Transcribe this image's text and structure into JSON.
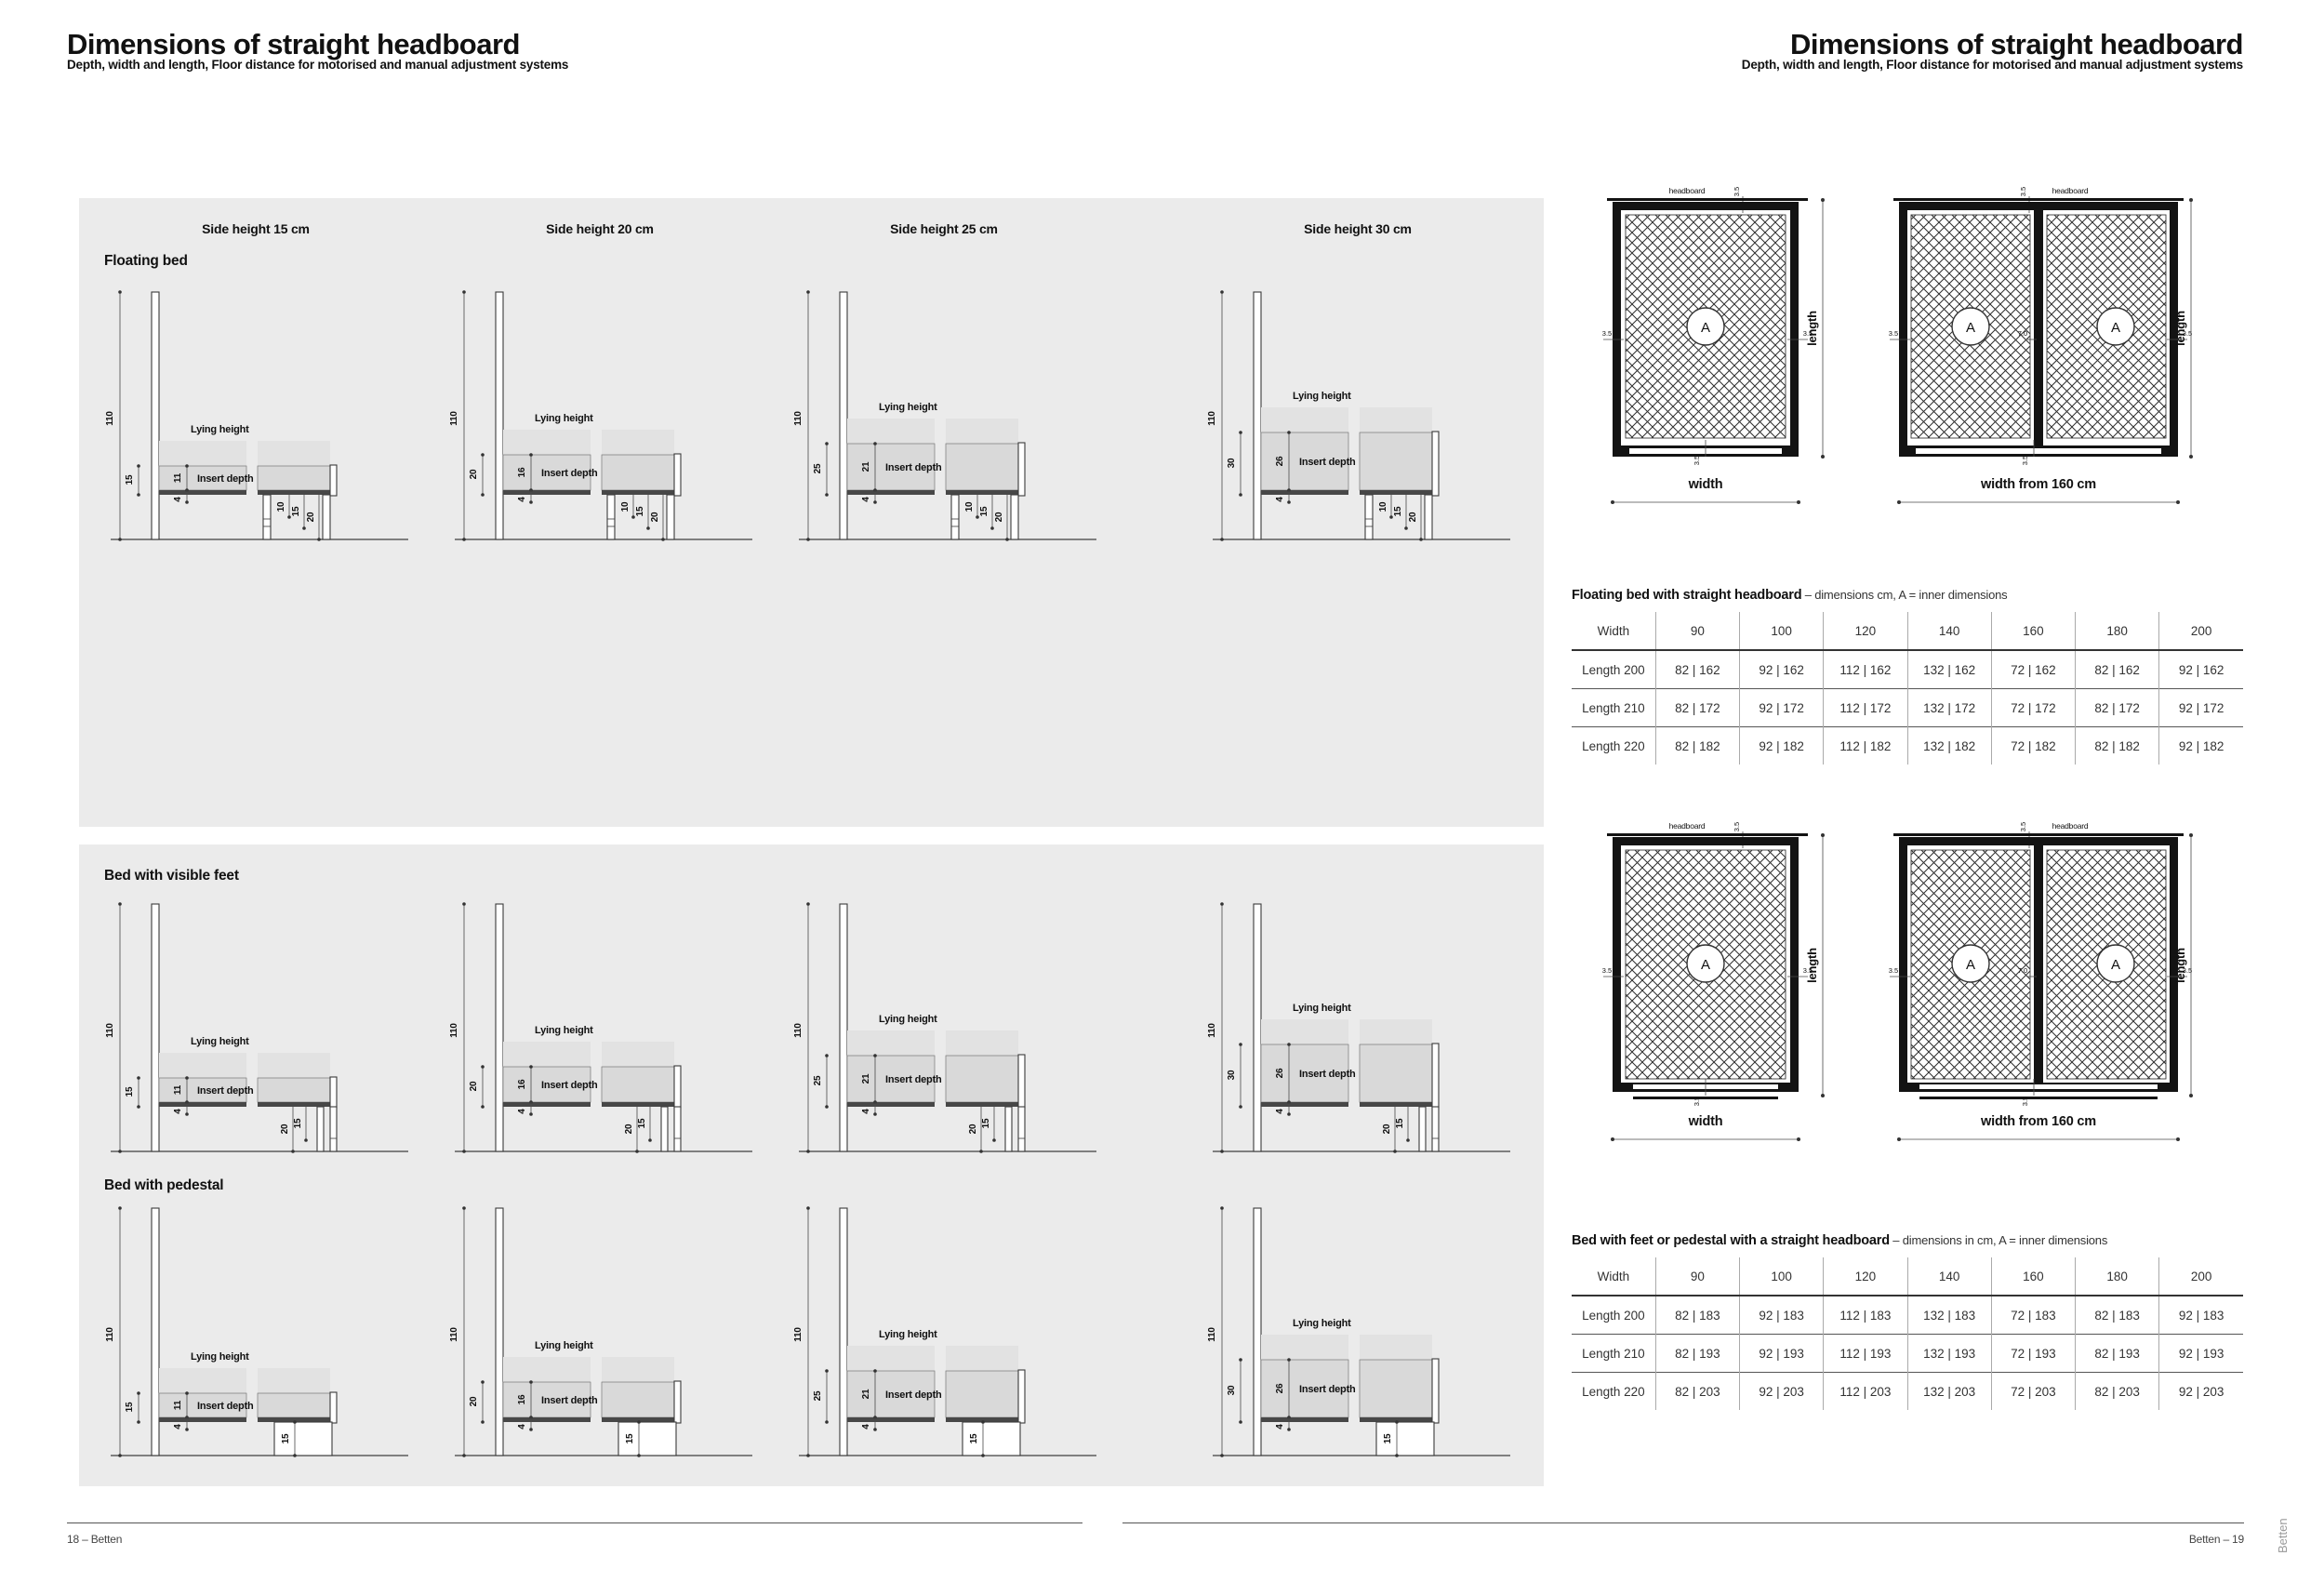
{
  "page_left": {
    "title": "Dimensions of straight headboard",
    "subtitle": "Depth, width and length, Floor distance for motorised and manual adjustment systems",
    "column_headers": [
      "Side height 15 cm",
      "Side height 20 cm",
      "Side height 25 cm",
      "Side height 30 cm"
    ],
    "labels": {
      "lying": "Lying height",
      "insert": "Insert depth"
    },
    "sections": [
      {
        "label": "Floating bed",
        "cols": [
          {
            "total": "110",
            "side": "15",
            "insert": "11",
            "base": "4",
            "floor1": "10",
            "floor2": "15",
            "floor3": "20"
          },
          {
            "total": "110",
            "side": "20",
            "insert": "16",
            "base": "4",
            "floor1": "10",
            "floor2": "15",
            "floor3": "20"
          },
          {
            "total": "110",
            "side": "25",
            "insert": "21",
            "base": "4",
            "floor1": "10",
            "floor2": "15",
            "floor3": "20"
          },
          {
            "total": "110",
            "side": "30",
            "insert": "26",
            "base": "4",
            "floor1": "10",
            "floor2": "15",
            "floor3": "20"
          }
        ]
      },
      {
        "label": "Bed with visible feet",
        "cols": [
          {
            "total": "110",
            "side": "15",
            "insert": "11",
            "base": "4",
            "floor1": "20",
            "floor2": "15"
          },
          {
            "total": "110",
            "side": "20",
            "insert": "16",
            "base": "4",
            "floor1": "20",
            "floor2": "15"
          },
          {
            "total": "110",
            "side": "25",
            "insert": "21",
            "base": "4",
            "floor1": "20",
            "floor2": "15"
          },
          {
            "total": "110",
            "side": "30",
            "insert": "26",
            "base": "4",
            "floor1": "20",
            "floor2": "15"
          }
        ]
      },
      {
        "label": "Bed with pedestal",
        "cols": [
          {
            "total": "110",
            "side": "15",
            "insert": "11",
            "base": "4",
            "floor1": "15"
          },
          {
            "total": "110",
            "side": "20",
            "insert": "16",
            "base": "4",
            "floor1": "15"
          },
          {
            "total": "110",
            "side": "25",
            "insert": "21",
            "base": "4",
            "floor1": "15"
          },
          {
            "total": "110",
            "side": "30",
            "insert": "26",
            "base": "4",
            "floor1": "15"
          }
        ]
      }
    ],
    "footer": "18 – Betten"
  },
  "page_right": {
    "title": "Dimensions of straight headboard",
    "subtitle": "Depth, width and length, Floor distance for motorised and manual adjustment systems",
    "topviews": {
      "headboard": "headboard",
      "length": "length",
      "width": "width",
      "width160": "width from 160 cm",
      "d35": "3.5",
      "d70": "7.0",
      "inner": "A"
    },
    "table1": {
      "caption_bold": "Floating bed with straight headboard",
      "caption_rest": " – dimensions cm, A = inner dimensions",
      "headers": [
        "Width",
        "90",
        "100",
        "120",
        "140",
        "160",
        "180",
        "200"
      ],
      "rows": [
        [
          "Length 200",
          "82 | 162",
          "92 | 162",
          "112 | 162",
          "132 | 162",
          "72 | 162",
          "82 | 162",
          "92 | 162"
        ],
        [
          "Length 210",
          "82 | 172",
          "92 | 172",
          "112 | 172",
          "132 | 172",
          "72 | 172",
          "82 | 172",
          "92 | 172"
        ],
        [
          "Length 220",
          "82 | 182",
          "92 | 182",
          "112 | 182",
          "132 | 182",
          "72 | 182",
          "82 | 182",
          "92 | 182"
        ]
      ]
    },
    "table2": {
      "caption_bold": "Bed with feet or pedestal with a straight headboard",
      "caption_rest": " – dimensions in cm, A = inner dimensions",
      "headers": [
        "Width",
        "90",
        "100",
        "120",
        "140",
        "160",
        "180",
        "200"
      ],
      "rows": [
        [
          "Length 200",
          "82 | 183",
          "92 | 183",
          "112 | 183",
          "132 | 183",
          "72 | 183",
          "82 | 183",
          "92 | 183"
        ],
        [
          "Length 210",
          "82 | 193",
          "92 | 193",
          "112 | 193",
          "132 | 193",
          "72 | 193",
          "82 | 193",
          "92 | 193"
        ],
        [
          "Length 220",
          "82 | 203",
          "92 | 203",
          "112 | 203",
          "132 | 203",
          "72 | 203",
          "82 | 203",
          "92 | 203"
        ]
      ]
    },
    "footer": "Betten – 19",
    "side_tab": "Betten"
  }
}
